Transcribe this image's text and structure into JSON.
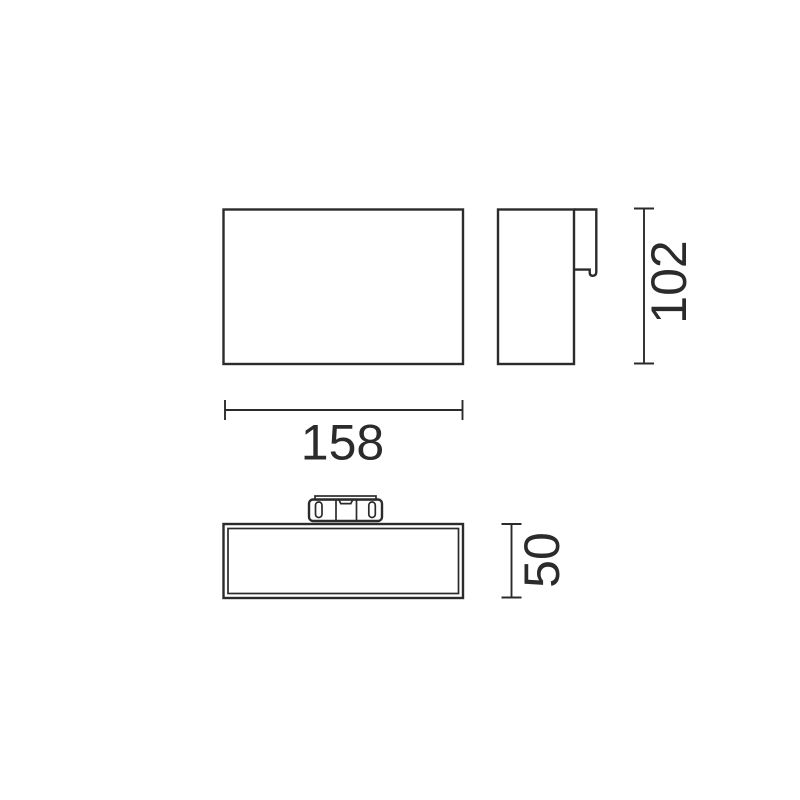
{
  "drawing": {
    "type": "technical-dimension-drawing",
    "dimensions": {
      "width": "158",
      "height": "102",
      "depth": "50"
    },
    "line_color": "#2b2b2b",
    "background_color": "#ffffff"
  }
}
